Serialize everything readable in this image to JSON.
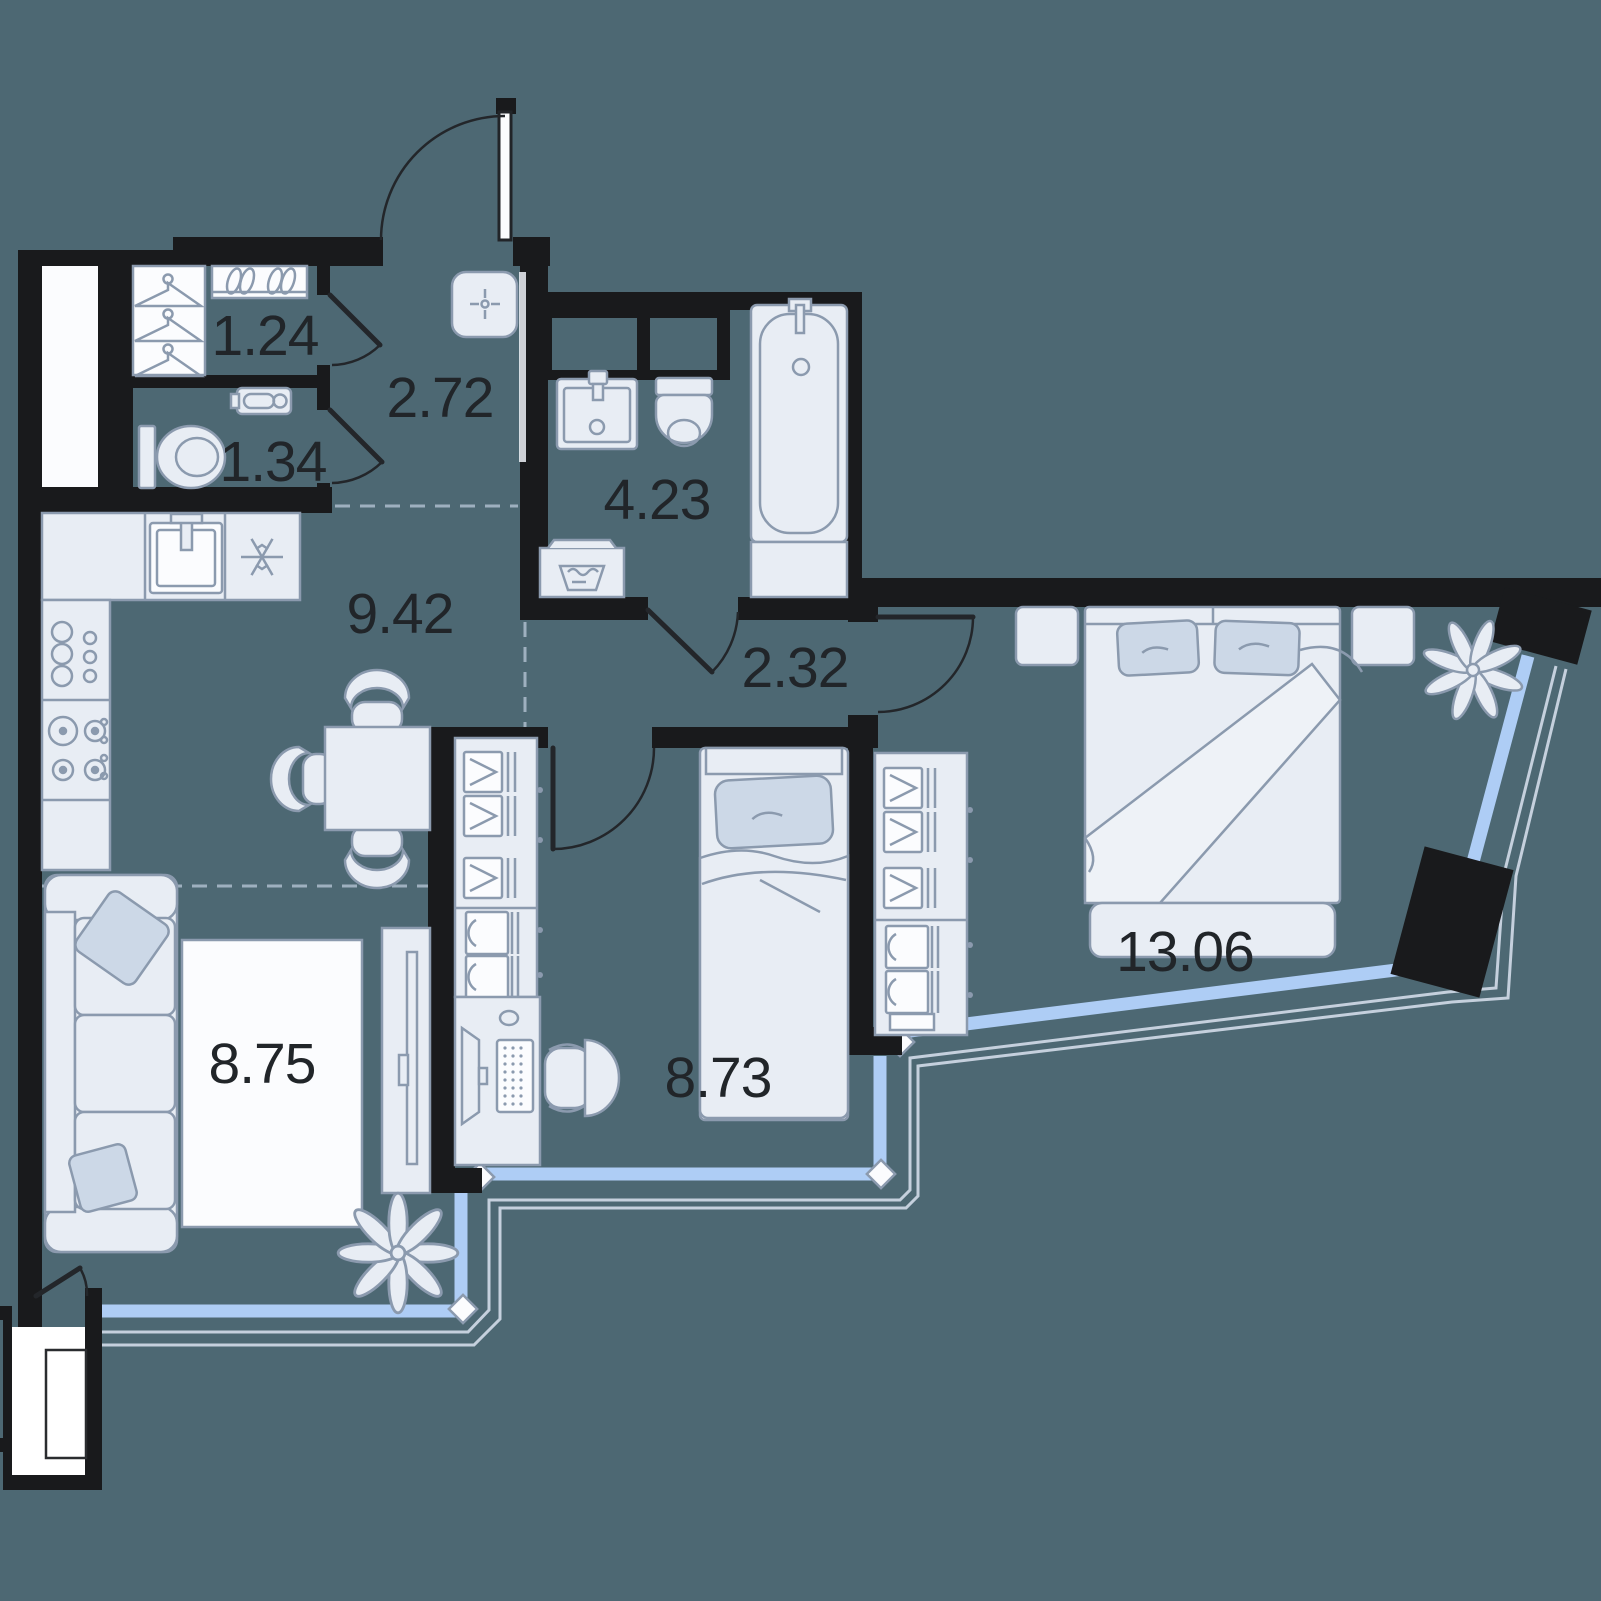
{
  "page": {
    "background": "#4d6873"
  },
  "floor_plan": {
    "rooms": [
      {
        "name": "closet",
        "area": "1.24"
      },
      {
        "name": "hallway",
        "area": "2.72"
      },
      {
        "name": "wc",
        "area": "1.34"
      },
      {
        "name": "bathroom",
        "area": "4.23"
      },
      {
        "name": "kitchen-dining",
        "area": "9.42"
      },
      {
        "name": "corridor",
        "area": "2.32"
      },
      {
        "name": "living-room",
        "area": "8.75"
      },
      {
        "name": "kids-room",
        "area": "8.73"
      },
      {
        "name": "bedroom",
        "area": "13.06"
      }
    ],
    "colors": {
      "wall": "#191a1c",
      "background": "#4d6873",
      "furniture_fill": "#e8edf4",
      "furniture_stroke": "#8b9aae",
      "window_glass": "#aecdf5",
      "balcony_outline": "#c5d0dd",
      "pillow": "#ccd8e7",
      "label_text": "#212529",
      "white_surface": "#fbfcfe"
    },
    "icons": {
      "hanger-icon": "triangle-with-hook",
      "shoes-icon": "paired-tilted-ellipses",
      "toilet-icon": "tank-plus-bowl",
      "hygiene-sink-icon": "small-wall-basin",
      "ceiling-light-icon": "rounded-square-with-star",
      "washbasin-icon": "rect-basin-with-tap",
      "bathtub-icon": "rounded-tub",
      "washing-machine-icon": "box-with-laundry-tub",
      "kitchen-sink-icon": "square-basin-with-tap",
      "snowflake-icon": "six-spoke-star",
      "stove-icon": "four-burners",
      "glassware-icon": "circle-cluster",
      "shirt-icon": "collar-chevron-on-rail",
      "drawer-icon": "rect-with-arc-handle",
      "plant-icon": "leaf-star",
      "monitor-icon": "trapezoid-screen",
      "keyboard-icon": "dotted-rect",
      "tv-icon": "thin-panel"
    }
  }
}
